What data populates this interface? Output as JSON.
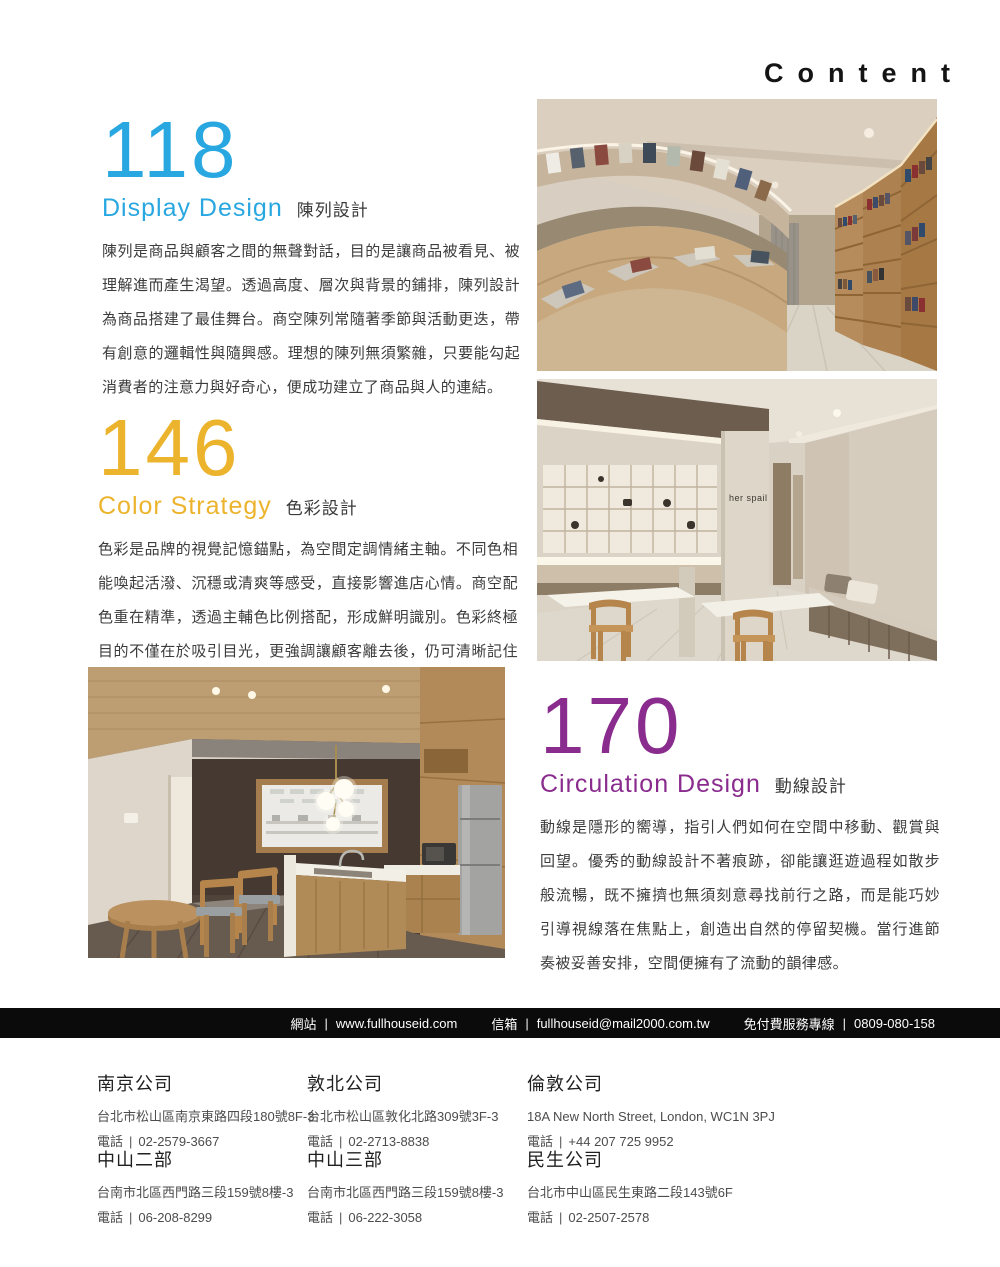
{
  "header": {
    "title": "Content"
  },
  "sections": [
    {
      "number": "118",
      "title_en": "Display Design",
      "title_zh": "陳列設計",
      "accent_color": "#29a7e0",
      "body": "陳列是商品與顧客之間的無聲對話，目的是讓商品被看見、被理解進而產生渴望。透過高度、層次與背景的鋪排，陳列設計為商品搭建了最佳舞台。商空陳列常隨著季節與活動更迭，帶有創意的邏輯性與隨興感。理想的陳列無須繁雜，只要能勾起消費者的注意力與好奇心，便成功建立了商品與人的連結。"
    },
    {
      "number": "146",
      "title_en": "Color Strategy",
      "title_zh": "色彩設計",
      "accent_color": "#ecb32c",
      "body": "色彩是品牌的視覺記憶錨點，為空間定調情緒主軸。不同色相能喚起活潑、沉穩或清爽等感受，直接影響進店心情。商空配色重在精準，透過主輔色比例搭配，形成鮮明識別。色彩終極目的不僅在於吸引目光，更強調讓顧客離去後，仍可清晰記住空間帶來的氛圍，並將品牌個性深深烙印於腦海中。"
    },
    {
      "number": "170",
      "title_en": "Circulation Design",
      "title_zh": "動線設計",
      "accent_color": "#8a2b8e",
      "body": "動線是隱形的嚮導，指引人們如何在空間中移動、觀賞與回望。優秀的動線設計不著痕跡，卻能讓逛遊過程如散步般流暢，既不擁擠也無須刻意尋找前行之路，而是能巧妙引導視線落在焦點上，創造出自然的停留契機。當行進節奏被妥善安排，空間便擁有了流動的韻律感。"
    }
  ],
  "photos": {
    "wall_sign": "her spail"
  },
  "labels": {
    "phone": "電話",
    "sep": "|"
  },
  "contact_bar": {
    "website_label": "網站",
    "website": "www.fullhouseid.com",
    "email_label": "信箱",
    "email": "fullhouseid@mail2000.com.tw",
    "hotline_label": "免付費服務專線",
    "hotline": "0809-080-158"
  },
  "offices": [
    {
      "name": "南京公司",
      "address": "台北市松山區南京東路四段180號8F-3",
      "phone": "02-2579-3667"
    },
    {
      "name": "敦北公司",
      "address": "台北市松山區敦化北路309號3F-3",
      "phone": "02-2713-8838"
    },
    {
      "name": "倫敦公司",
      "address": "18A New North Street, London, WC1N 3PJ",
      "phone": "+44 207 725 9952"
    },
    {
      "name": "中山二部",
      "address": "台南市北區西門路三段159號8樓-3",
      "phone": "06-208-8299"
    },
    {
      "name": "中山三部",
      "address": "台南市北區西門路三段159號8樓-3",
      "phone": "06-222-3058"
    },
    {
      "name": "民生公司",
      "address": "台北市中山區民生東路二段143號6F",
      "phone": "02-2507-2578"
    }
  ]
}
